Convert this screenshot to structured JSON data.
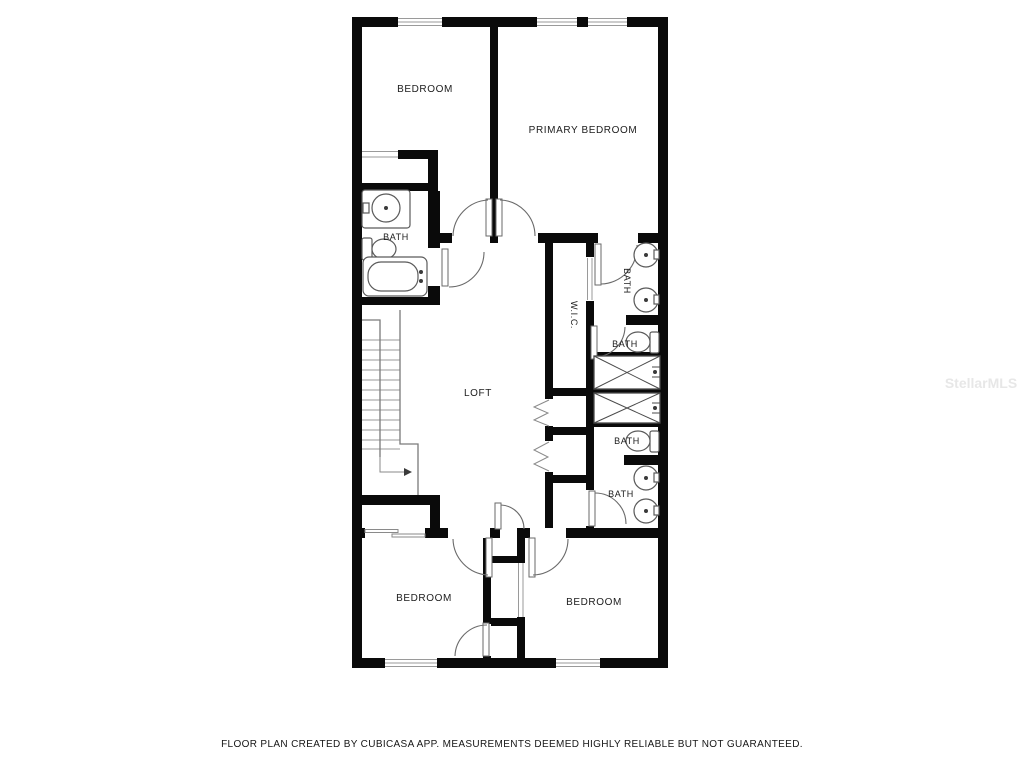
{
  "page": {
    "footer_note": "FLOOR PLAN CREATED BY CUBICASA APP. MEASUREMENTS DEEMED HIGHLY RELIABLE BUT NOT GUARANTEED.",
    "watermark": "StellarMLS"
  },
  "floor_plan": {
    "rooms": {
      "bedroom_top_left": {
        "label": "BEDROOM"
      },
      "primary_bedroom": {
        "label": "PRIMARY BEDROOM"
      },
      "bath_left": {
        "label": "BATH"
      },
      "bath_right_top": {
        "label": "BATH"
      },
      "wic": {
        "label": "W.I.C."
      },
      "bath_right_mid1": {
        "label": "BATH"
      },
      "bath_right_mid2": {
        "label": "BATH"
      },
      "bath_right_bottom": {
        "label": "BATH"
      },
      "loft": {
        "label": "LOFT"
      },
      "bedroom_bottom_left": {
        "label": "BEDROOM"
      },
      "bedroom_bottom_right": {
        "label": "BEDROOM"
      }
    },
    "colors": {
      "wall": "#0a0a0a",
      "background": "#ffffff",
      "fixture_stroke": "#5a5a5a",
      "label_text": "#1c1c1c",
      "watermark_text": "#e7e7e7"
    }
  }
}
